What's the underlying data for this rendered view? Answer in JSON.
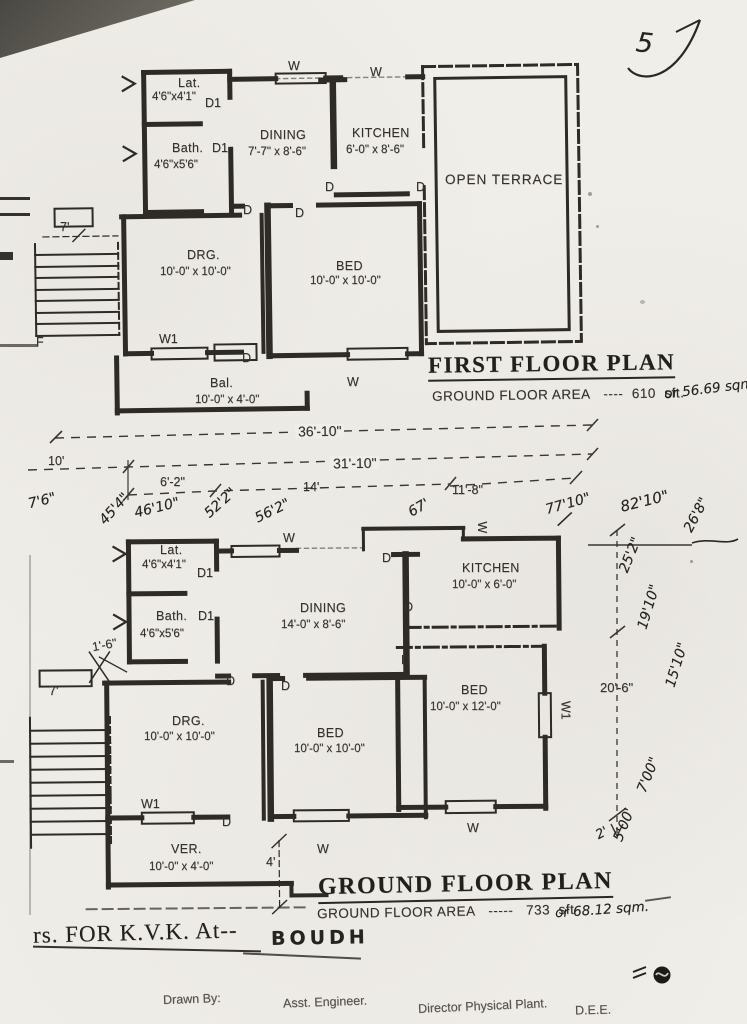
{
  "colors": {
    "paper": "#f0eee9",
    "ink": "#2e2b27",
    "ink_faint": "#55504a"
  },
  "page": {
    "number_hw": "5"
  },
  "markers": {
    "door": "D",
    "door_1": "D1",
    "window": "W",
    "window_1": "W1",
    "f_label": "F"
  },
  "first_floor": {
    "title": "FIRST FLOOR PLAN",
    "area_line": {
      "label": "GROUND FLOOR AREA",
      "dashes": "----",
      "value": "610",
      "unit": "sft.",
      "handwritten": "or 56.69 sqm"
    },
    "rooms": {
      "lat": {
        "name": "Lat.",
        "dims": "4'6\"x4'1\""
      },
      "bath": {
        "name": "Bath.",
        "dims": "4'6\"x5'6\""
      },
      "dining": {
        "name": "DINING",
        "dims": "7'-7\" x 8'-6\""
      },
      "kitchen": {
        "name": "KITCHEN",
        "dims": "6'-0\" x 8'-6\""
      },
      "terrace": {
        "name": "OPEN TERRACE"
      },
      "drg": {
        "name": "DRG.",
        "dims": "10'-0\" x 10'-0\""
      },
      "bed": {
        "name": "BED",
        "dims": "10'-0\" x 10'-0\""
      },
      "bal": {
        "name": "Bal.",
        "dims": "10'-0\" x 4'-0\""
      }
    },
    "stair_dim": "7'"
  },
  "dim_strings": {
    "total_width": "36'-10\"",
    "left_seg": "10'",
    "main_seg": "31'-10\"",
    "sub1": "6'-2\"",
    "sub2": "14'",
    "sub3": "11'-8\"",
    "hw_76": "7'6\"",
    "hw_454": "45'4\"",
    "hw_4610": "46'10\"",
    "hw_522": "52'2\"",
    "hw_562": "56'2\"",
    "hw_67": "67'",
    "hw_7710": "77'10\"",
    "hw_8210": "82'10\"",
    "hw_268": "26'8\""
  },
  "right_dims": {
    "printed_206": "20'-6\"",
    "hw_252": "25'2\"",
    "hw_1910": "19'10\"",
    "hw_1510": "15'10\"",
    "hw_700": "7'00\"",
    "hw_500": "5'00'",
    "hw_2": "2'"
  },
  "ground_floor": {
    "title": "GROUND FLOOR PLAN",
    "area_line": {
      "label": "GROUND FLOOR AREA",
      "dashes": "-----",
      "value": "733",
      "unit": "sft",
      "handwritten": "or 68.12 sqm."
    },
    "rooms": {
      "lat": {
        "name": "Lat.",
        "dims": "4'6\"x4'1\""
      },
      "bath": {
        "name": "Bath.",
        "dims": "4'6\"x5'6\""
      },
      "dining": {
        "name": "DINING",
        "dims": "14'-0\" x 8'-6\""
      },
      "kitchen": {
        "name": "KITCHEN",
        "dims": "10'-0\" x 6'-0\""
      },
      "bed_right": {
        "name": "BED",
        "dims": "10'-0\" x 12'-0\""
      },
      "drg": {
        "name": "DRG.",
        "dims": "10'-0\" x 10'-0\""
      },
      "bed": {
        "name": "BED",
        "dims": "10'-0\" x 10'-0\""
      },
      "ver": {
        "name": "VER.",
        "dims": "10'-0\" x 4'-0\""
      }
    },
    "stair_dim": "7'",
    "offset_dim": "1'-6\"",
    "ver_dim": "4'"
  },
  "footer": {
    "project_prefix": "rs. FOR K.V.K. At--",
    "location_hw": "BOUDH",
    "signatures": [
      "Drawn By:",
      "Asst. Engineer.",
      "Director Physical Plant.",
      "D.E.E."
    ]
  }
}
